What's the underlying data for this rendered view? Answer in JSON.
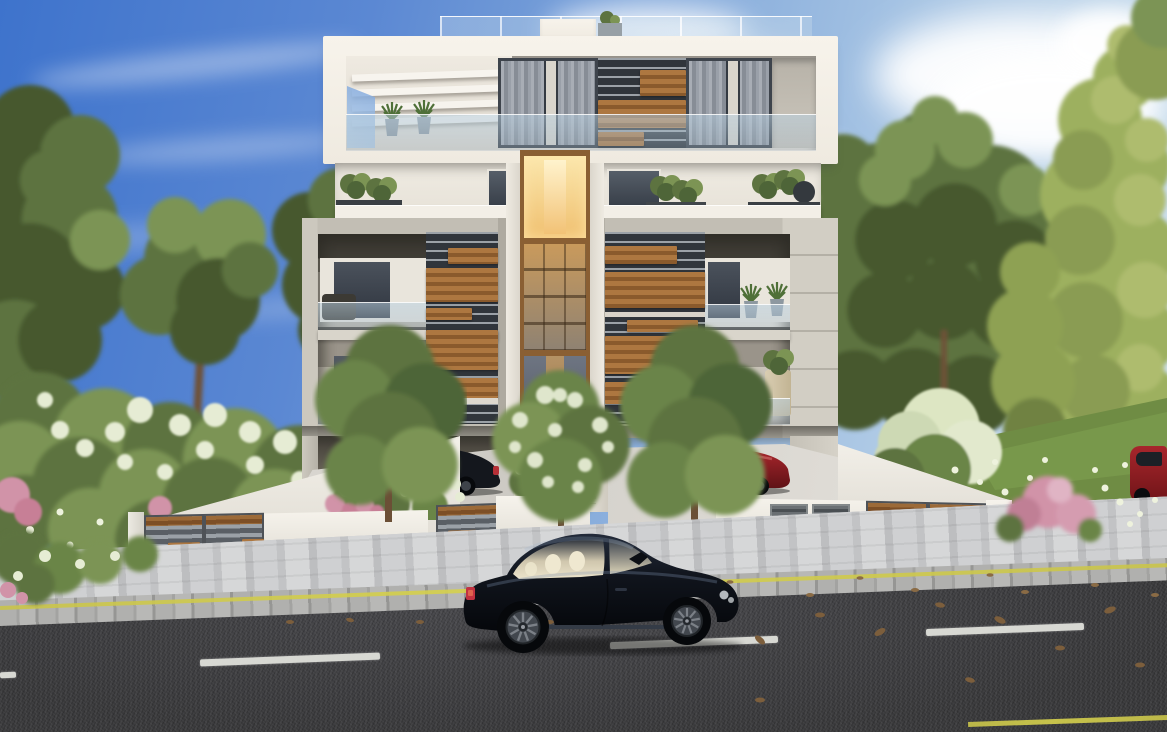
{
  "scene": {
    "type": "architectural-exterior-rendering",
    "objects": [
      "sky",
      "clouds",
      "trees",
      "shrubs",
      "lawn",
      "modern-apartment-building",
      "penthouse-terrace",
      "pergola",
      "curtained-windows",
      "timber-slat-screens",
      "glass-balustrades",
      "elevator-shaft",
      "balconies",
      "potted-plants",
      "carport",
      "parked-black-car",
      "parked-red-car",
      "parked-red-car-far-right",
      "boundary-wall",
      "slatted-gate-left",
      "slatted-gate-small",
      "slatted-gate-right",
      "utility-doors",
      "flower-planter",
      "flower-bed",
      "sidewalk",
      "curb",
      "asphalt-road",
      "lane-markings",
      "yellow-edge-line",
      "fallen-leaves",
      "black-luxury-coupe"
    ]
  },
  "colors": {
    "sky-top": "#3e73cc",
    "sky-mid": "#7fa6da",
    "sky-light": "#c8dcec",
    "cloud": "#ffffff",
    "foliage-dark": "#46582f",
    "foliage-mid": "#5d7340",
    "foliage-light": "#7c9454",
    "foliage-yellow": "#9db05e",
    "foliage-pale": "#aebc6e",
    "blossom-white": "#e6ecd4",
    "blossom-pink": "#d193a8",
    "grass": "#6f8c44",
    "daisy": "#eef2dd",
    "building-white": "#f4f0e8",
    "building-shade": "#ddd8ce",
    "concrete": "#c2beb4",
    "concrete-light": "#d2cec4",
    "recess-shadow": "#413e37",
    "glass-dark": "#3a414a",
    "curtain-light": "#a8adb5",
    "curtain-dark": "#878d96",
    "wood": "#ad7740",
    "wood-dark": "#8a5a2c",
    "slat-gray": "#9ba1a7",
    "slat-dark": "#30353b",
    "lift-glow": "#fbe7ad",
    "lift-amber": "#e8b06a",
    "lift-frame": "#8a5f33",
    "balustrade-glass": "#b9d0e0",
    "wall-white": "#f1ede4",
    "gate-steel": "#5a5f65",
    "gate-wood": "#9c6a38",
    "pavement": "#c6c7c9",
    "paver-light": "#d6d7d8",
    "curb-stone": "#a3a3a1",
    "road": "#3a3a3c",
    "road-mark": "#e0e1db",
    "yellow-line": "#d6d14d",
    "car-black": "#10141c",
    "car-glass-cream": "#e8e1c9",
    "car-rim": "#565b62",
    "taillight": "#c23240",
    "car-red": "#a8262c",
    "leaf-brown": "#7c5e3c"
  }
}
